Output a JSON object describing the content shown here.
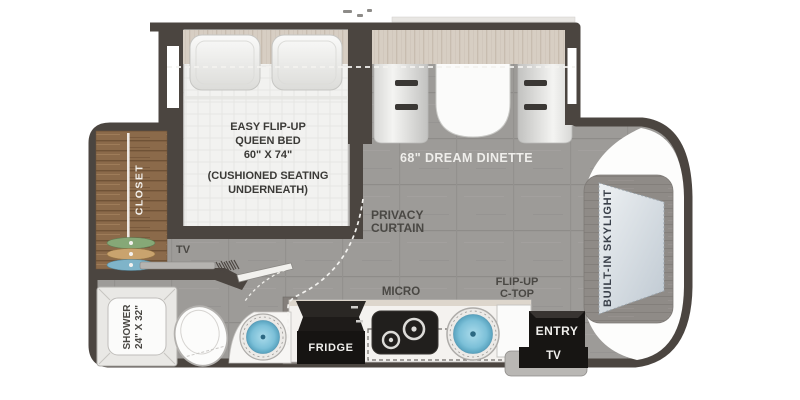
{
  "plan": {
    "bedroom": {
      "bed_label_lines": [
        "EASY FLIP-UP",
        "QUEEN BED",
        "60\" X 74\""
      ],
      "bed_sub_lines": [
        "(CUSHIONED SEATING",
        "UNDERNEATH)"
      ],
      "closet_label": "CLOSET",
      "tv_label": "TV",
      "privacy_lines": [
        "PRIVACY",
        "CURTAIN"
      ]
    },
    "dinette": {
      "label": "68\" DREAM DINETTE"
    },
    "rear": {
      "skylight_label": "BUILT-IN SKYLIGHT"
    },
    "bath": {
      "shower_lines": [
        "SHOWER",
        "24\" X 32\""
      ]
    },
    "kitchen": {
      "fridge_label": "FRIDGE",
      "micro_label": "MICRO",
      "flip_lines": [
        "FLIP-UP",
        "C-TOP"
      ]
    },
    "entry": {
      "entry_label": "ENTRY",
      "tv_label": "TV"
    }
  },
  "colors": {
    "wall": "#4b4540",
    "floor": "#9d9b98",
    "closet_wood": "#8b6a4a",
    "headboard_band": "#d7cec3",
    "sink_blue": "#7cc0d8",
    "skylight_glass": "#d6dee5",
    "appliance_black": "#171513",
    "hanger_green": "#86a877",
    "hanger_tan": "#c9a36e",
    "hanger_blue": "#7fb4c9",
    "label_dark": "#4a4844",
    "label_light": "#f0efec"
  }
}
